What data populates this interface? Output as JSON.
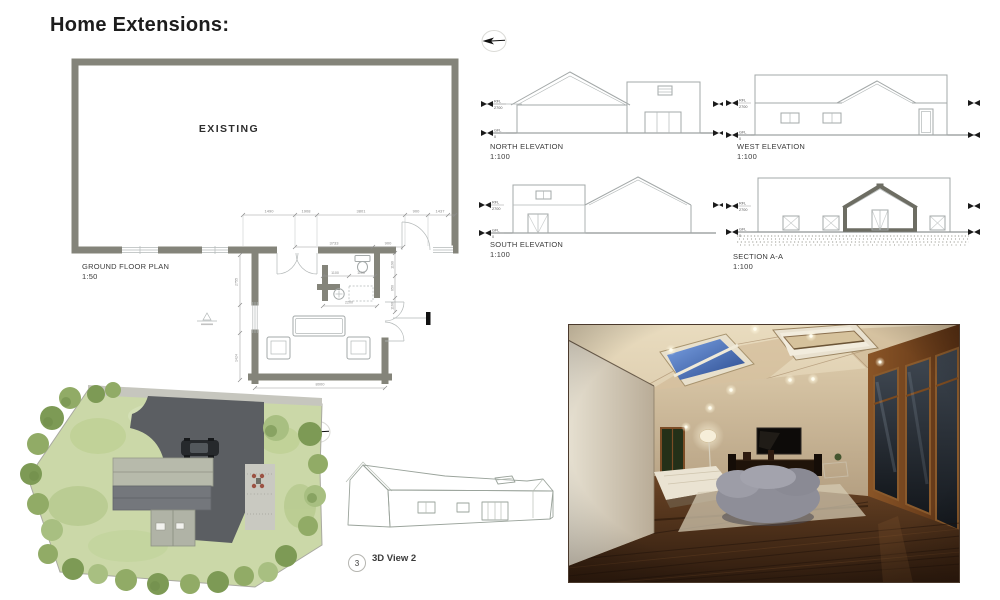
{
  "title": "Home Extensions:",
  "floor_plan": {
    "room_label": "EXISTING",
    "caption": "GROUND FLOOR PLAN",
    "scale": "1:50",
    "dims_top": [
      "1490",
      "1908",
      "3801",
      "900",
      "1437"
    ],
    "dims_inner": [
      "3733",
      "900"
    ],
    "dims_left": [
      "2755",
      "1424"
    ],
    "dims_right": [
      "1190",
      "650",
      "1160"
    ],
    "dim_bottom": "8000",
    "wc_dims": [
      "1100",
      "1100"
    ],
    "wc_width": "2200"
  },
  "elevations": [
    {
      "name": "NORTH ELEVATION",
      "scale": "1:100"
    },
    {
      "name": "WEST ELEVATION",
      "scale": "1:100"
    },
    {
      "name": "SOUTH ELEVATION",
      "scale": "1:100"
    },
    {
      "name": "SECTION A-A",
      "scale": "1:100"
    }
  ],
  "levels": {
    "rfl": "RFL",
    "rfl_value": "2700",
    "gfl": "GFL",
    "gfl_value": "0"
  },
  "view3d": {
    "number": "3",
    "label": "3D View 2"
  },
  "colors": {
    "wall": "#84847A",
    "line": "#a3a8a8",
    "lawn": "#cbd8a8",
    "drive": "#5b5e62",
    "sky": "#3f6cb8"
  }
}
